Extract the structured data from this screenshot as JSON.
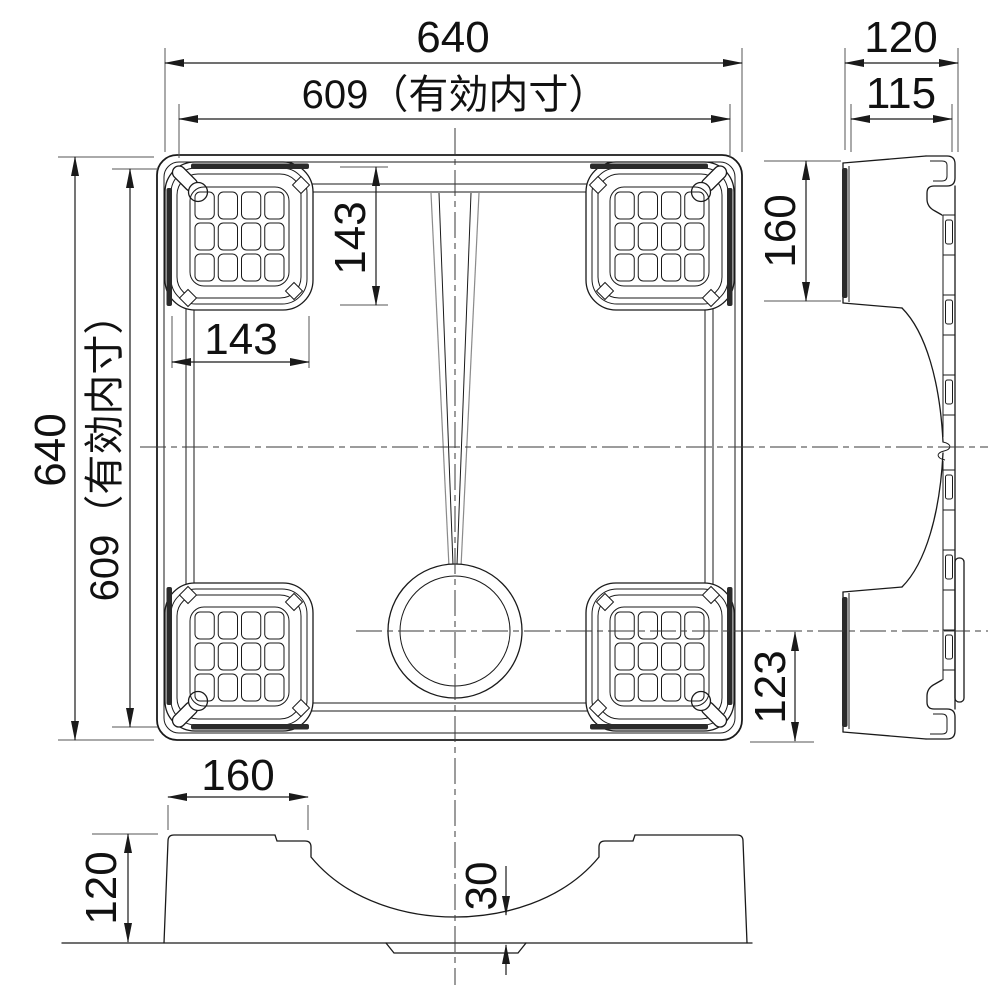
{
  "drawing": {
    "labels": {
      "top_width": "640",
      "top_inner_width": "609（有効内寸）",
      "left_height": "640",
      "left_inner_height": "609（有効内寸）",
      "pad_height_v": "143",
      "pad_width_h": "143",
      "drain_offset": "123",
      "side_top_width": "120",
      "side_top_inner": "115",
      "side_pad_height": "160",
      "front_pad_width": "160",
      "front_height": "120",
      "front_gap": "30"
    },
    "colors": {
      "line": "#1a1a1a",
      "centerline": "#3a3a3a",
      "hairline": "#8a8a8a",
      "rubber_strip": "#2b2b2b",
      "background": "#ffffff"
    }
  }
}
